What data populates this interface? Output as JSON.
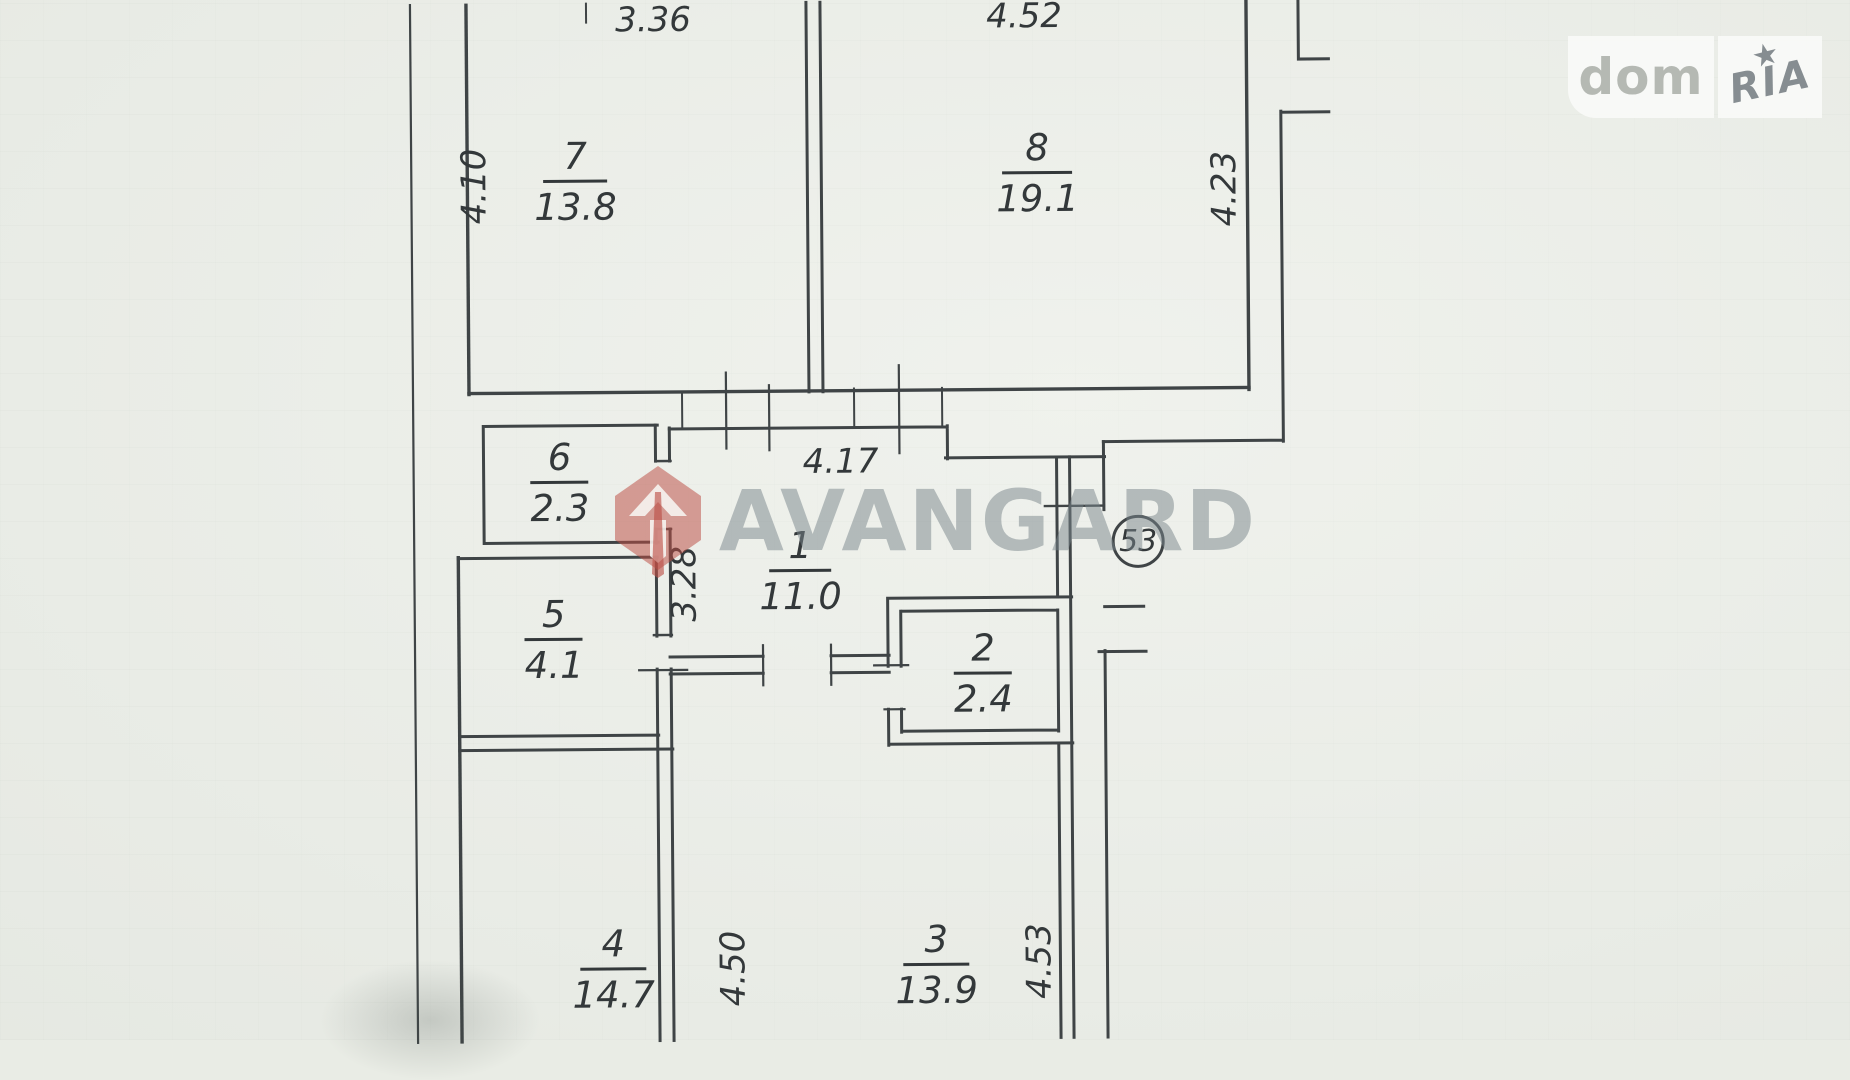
{
  "paper": {
    "background": "#e9ece5",
    "wall_color": "#3f4446",
    "text_color": "#33383a"
  },
  "apartment": {
    "number_badge": "53"
  },
  "rooms": [
    {
      "number": "1",
      "area": "11.0"
    },
    {
      "number": "2",
      "area": "2.4"
    },
    {
      "number": "3",
      "area": "13.9"
    },
    {
      "number": "4",
      "area": "14.7"
    },
    {
      "number": "5",
      "area": "4.1"
    },
    {
      "number": "6",
      "area": "2.3"
    },
    {
      "number": "7",
      "area": "13.8"
    },
    {
      "number": "8",
      "area": "19.1"
    }
  ],
  "dimensions": [
    {
      "value": "3.36"
    },
    {
      "value": "4.52"
    },
    {
      "value": "4.10"
    },
    {
      "value": "4.23"
    },
    {
      "value": "4.17"
    },
    {
      "value": "3.28"
    },
    {
      "value": "4.50"
    },
    {
      "value": "4.53"
    }
  ],
  "watermarks": {
    "brand": "AVANGARD",
    "portal": {
      "left": "dom",
      "right": "RIA"
    }
  }
}
